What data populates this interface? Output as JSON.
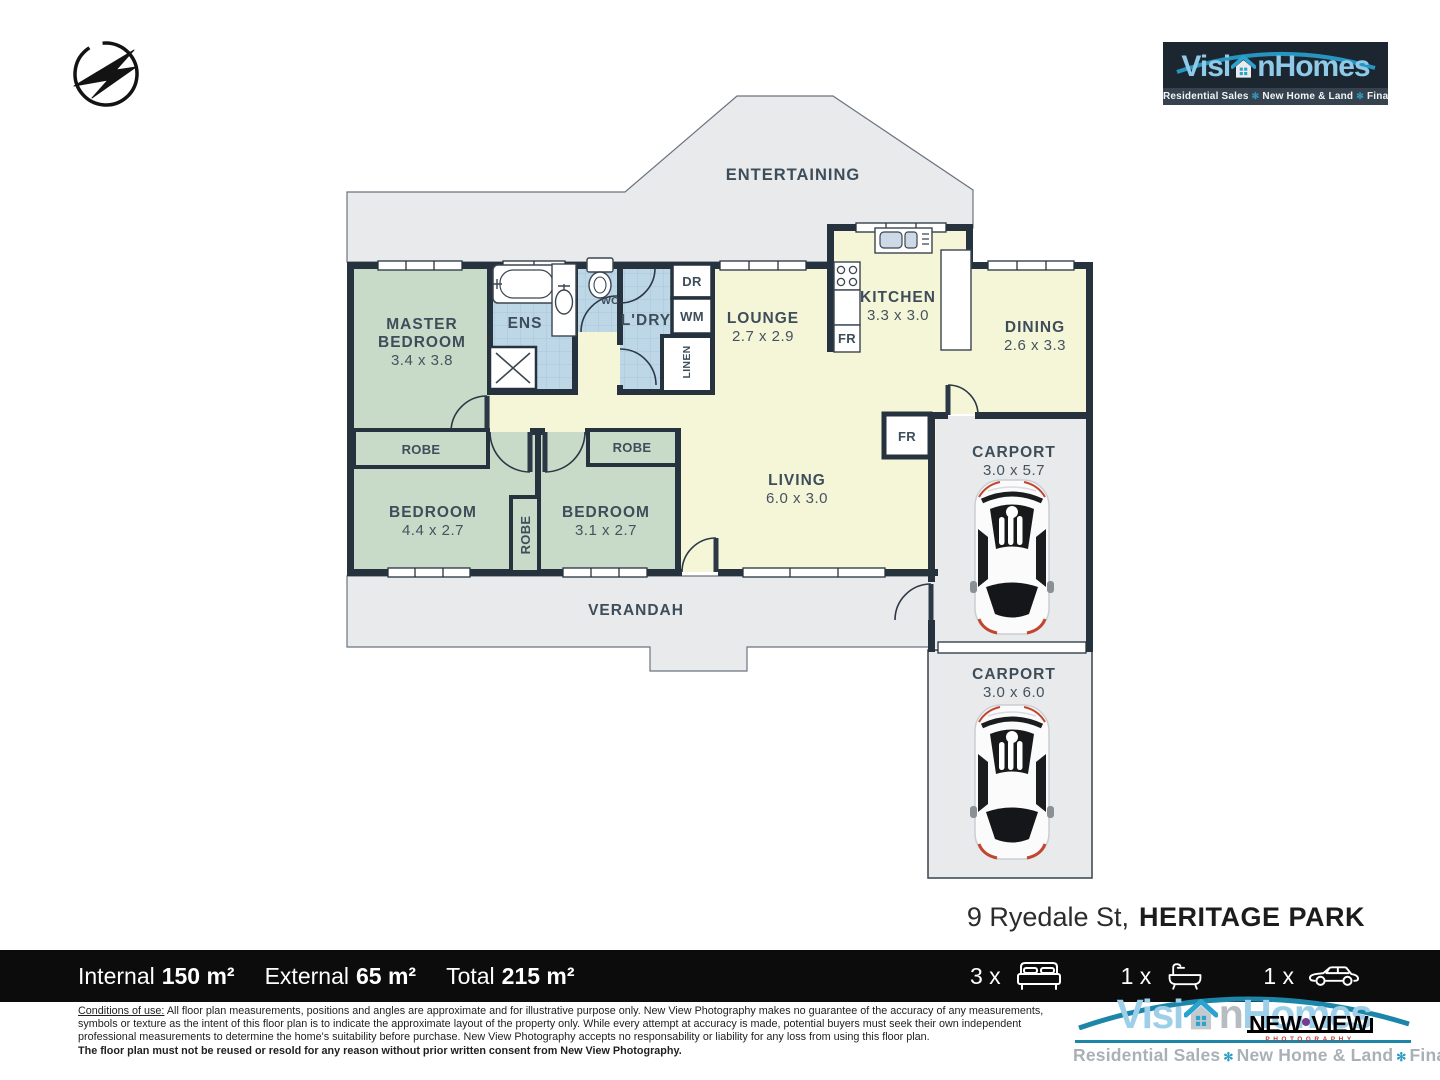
{
  "logo": {
    "part1": "Visi",
    "part2": "n",
    "part3": "Homes",
    "tag1": "Residential Sales",
    "tag2": "New Home & Land",
    "tag3": "Finance",
    "sep": "✻"
  },
  "newview": {
    "word1": "NEW",
    "word2": "VIEW",
    "sub": "PHOTOGRAPHY"
  },
  "rooms": {
    "entertaining": {
      "name": "ENTERTAINING"
    },
    "master": {
      "line1": "MASTER",
      "line2": "BEDROOM",
      "dims": "3.4 x 3.8"
    },
    "ens": {
      "name": "ENS"
    },
    "wc": {
      "name": "WC"
    },
    "ldry": {
      "name": "L'DRY"
    },
    "dr": {
      "name": "DR"
    },
    "wm": {
      "name": "WM"
    },
    "linen": {
      "name": "LINEN"
    },
    "lounge": {
      "name": "LOUNGE",
      "dims": "2.7 x 2.9"
    },
    "kitchen": {
      "name": "KITCHEN",
      "dims": "3.3 x 3.0"
    },
    "dining": {
      "name": "DINING",
      "dims": "2.6 x 3.3"
    },
    "fr_kitchen": {
      "name": "FR"
    },
    "fr_living": {
      "name": "FR"
    },
    "robe_master": {
      "name": "ROBE"
    },
    "robe_bed2": {
      "name": "ROBE"
    },
    "robe_mid": {
      "name": "ROBE"
    },
    "bedroom1": {
      "line1": "BEDROOM",
      "dims": "4.4 x 2.7"
    },
    "bedroom2": {
      "line1": "BEDROOM",
      "dims": "3.1 x 2.7"
    },
    "living": {
      "name": "LIVING",
      "dims": "6.0 x 3.0"
    },
    "carport1": {
      "name": "CARPORT",
      "dims": "3.0 x 5.7"
    },
    "carport2": {
      "name": "CARPORT",
      "dims": "3.0 x 6.0"
    },
    "verandah": {
      "name": "VERANDAH"
    }
  },
  "address": {
    "street": "9 Ryedale St,",
    "suburb": "HERITAGE PARK"
  },
  "footer": {
    "stats": [
      {
        "label": "Internal",
        "value": "150 m²"
      },
      {
        "label": "External",
        "value": "65 m²"
      },
      {
        "label": "Total",
        "value": "215 m²"
      }
    ],
    "counts": [
      {
        "qty": "3 x",
        "icon": "bed-icon"
      },
      {
        "qty": "1 x",
        "icon": "bath-icon"
      },
      {
        "qty": "1 x",
        "icon": "car-icon"
      }
    ]
  },
  "disclaimer": {
    "heading": "Conditions of use:",
    "line1": " All floor plan measurements, positions and angles are approximate and for illustrative purpose only. New View Photography makes no guarantee of the accuracy of any measurements,",
    "line2": "symbols or texture as the intent of this floor plan is to indicate the approximate layout of the property only. While every attempt at accuracy is made, potential buyers must seek their own independent",
    "line3": "professional measurements to determine the home's suitability before purchase. New View Photography accepts no responsability or liability for any loss from using this floor plan.",
    "line4": "The floor plan must not be reused or resold for any reason without prior written consent from New View Photography."
  },
  "colors": {
    "wall": "#27323f",
    "floor_cream": "#f5f6d8",
    "floor_green": "#c8dac8",
    "floor_tile": "#bdd7e7",
    "outdoor_gray": "#e8eaeb",
    "brand_blue": "#8fcbe9",
    "brand_teal": "#1d86a8",
    "newview_red": "#c03a2e"
  }
}
